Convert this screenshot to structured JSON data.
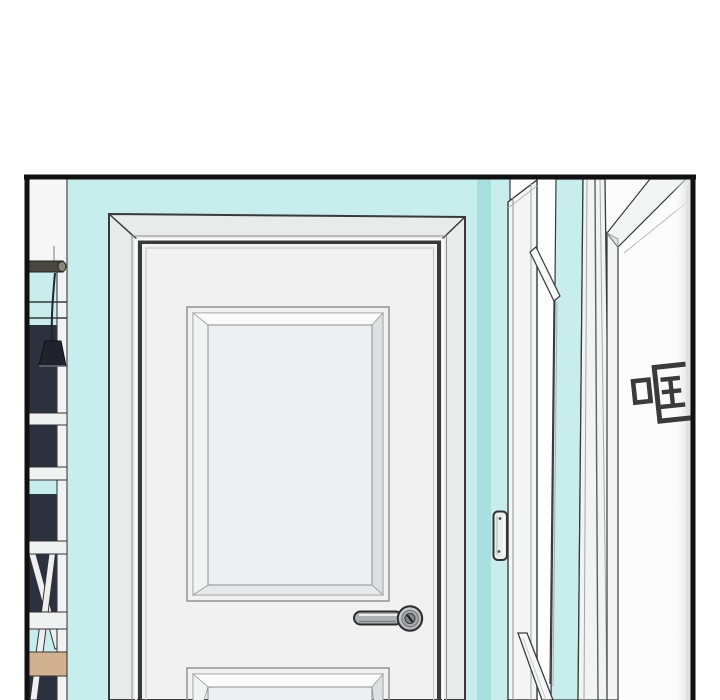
{
  "panel": {
    "kind": "comic-panel",
    "border_color": "#111111"
  },
  "sfx": {
    "text": "哐",
    "color": "#3b3b3b"
  },
  "colors": {
    "page_bg": "#ffffff",
    "panel_bg": "#fefefe",
    "border": "#111111",
    "teal": "#c8eded",
    "teal_dark": "#a9dfe1",
    "door_face": "#f1f1f2",
    "frame_gray": "#e9eaea",
    "panel_field": "#eeeff0",
    "bevel_light": "#fbfbfc",
    "bevel_dark": "#dddfe0",
    "outline": "#3a3a3a",
    "navy": "#2c3140",
    "lamp": "#20232e",
    "wood": "#d2b190",
    "rod_brown": "#4b463d",
    "white_trim": "#f3f4f4",
    "handle": "#aeb0b2",
    "handle_dark": "#85878a",
    "shade_gradient_end": "#d9dadb",
    "sfx_text": "#3b3b3b"
  }
}
